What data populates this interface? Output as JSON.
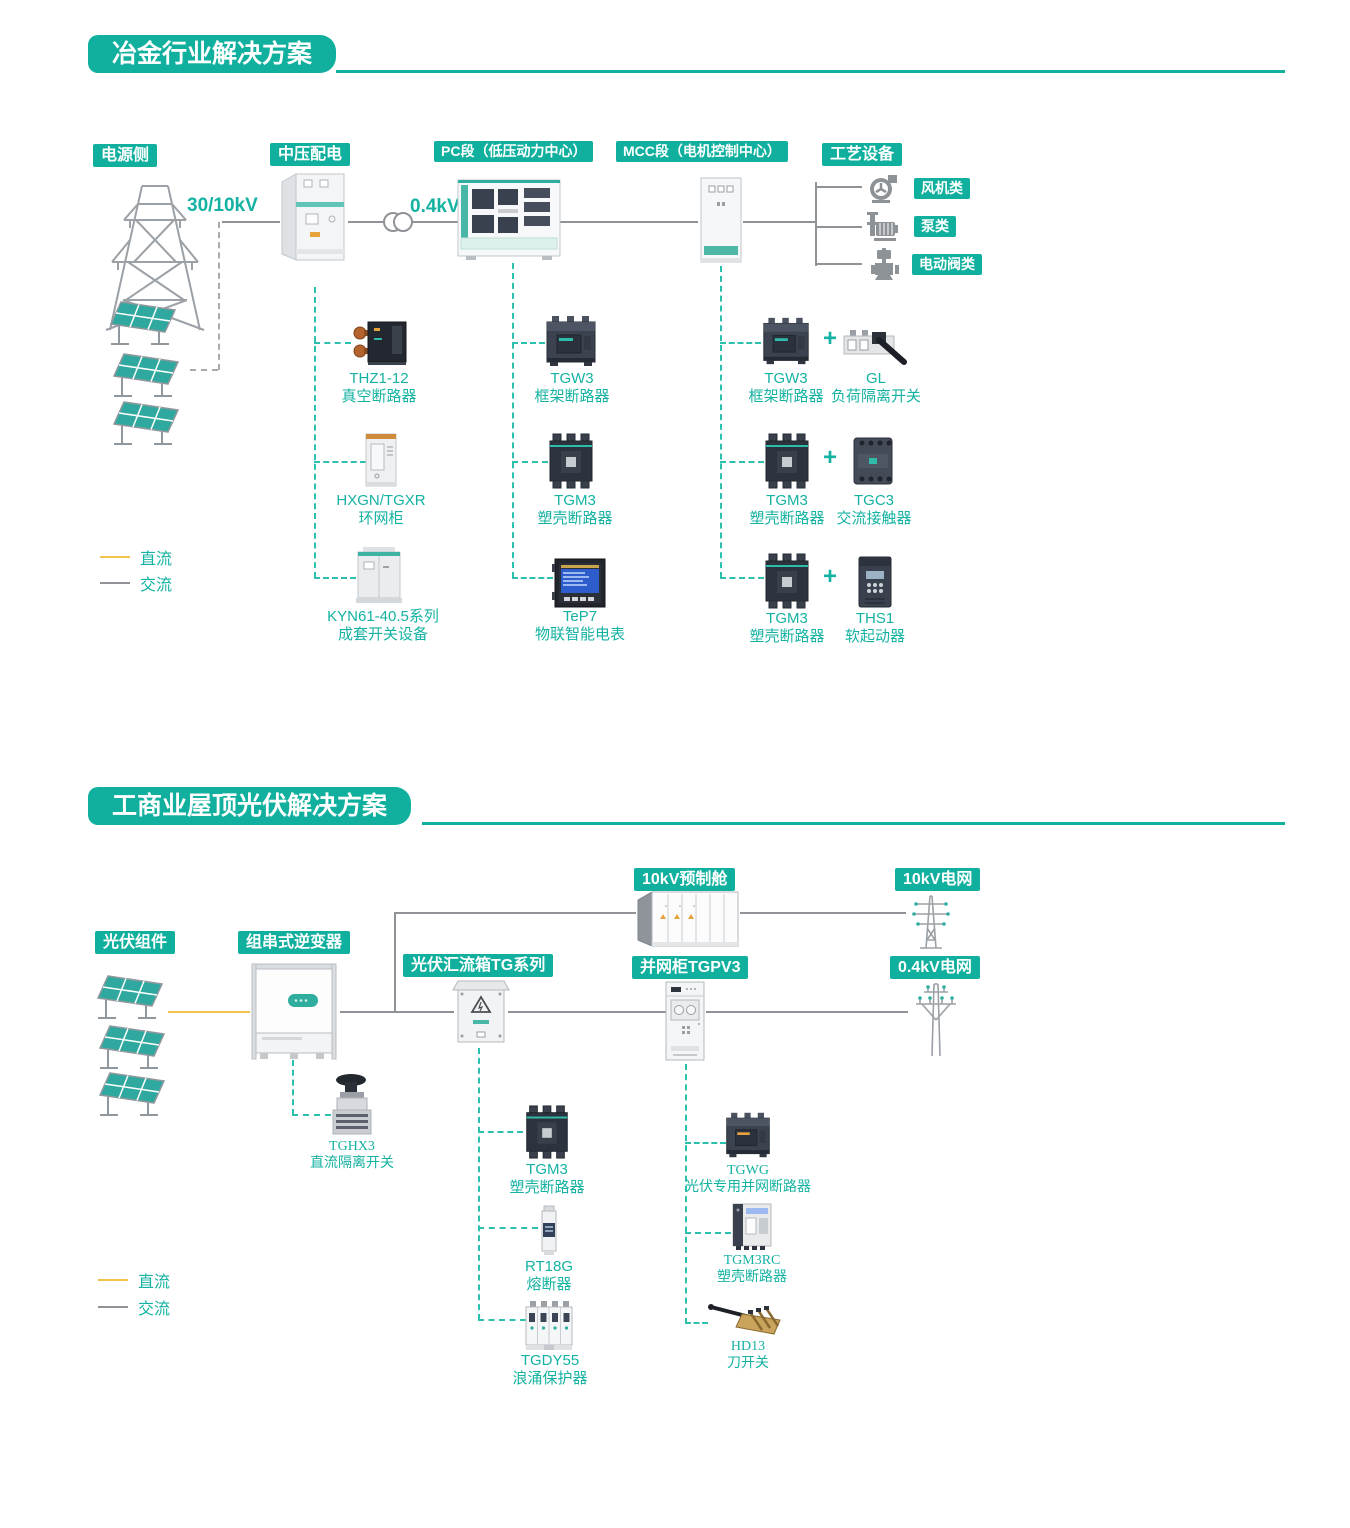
{
  "colors": {
    "teal": "#11b09e",
    "teal_dash": "#2ec0ae",
    "dc_yellow": "#f2c14e",
    "ac_gray": "#8f9296",
    "label_teal": "#14b2a2"
  },
  "s1": {
    "title": "冶金行业解决方案",
    "badges": {
      "power": "电源侧",
      "mv": "中压配电",
      "pc": "PC段（低压动力中心）",
      "mcc": "MCC段（电机控制中心）",
      "process": "工艺设备"
    },
    "voltages": {
      "grid": "30/10kV",
      "lv": "0.4kV"
    },
    "loads": [
      {
        "label": "风机类",
        "icon": "fan-icon"
      },
      {
        "label": "泵类",
        "icon": "pump-icon"
      },
      {
        "label": "电动阀类",
        "icon": "valve-icon"
      }
    ],
    "mv_products": [
      {
        "name": "THZ1-12",
        "desc": "真空断路器"
      },
      {
        "name": "HXGN/TGXR",
        "desc": "环网柜"
      },
      {
        "name": "KYN61-40.5系列",
        "desc": "成套开关设备"
      }
    ],
    "pc_products": [
      {
        "name": "TGW3",
        "desc": "框架断路器"
      },
      {
        "name": "TGM3",
        "desc": "塑壳断路器"
      },
      {
        "name": "TeP7",
        "desc": "物联智能电表"
      }
    ],
    "mcc_rows": [
      {
        "a": {
          "name": "TGW3",
          "desc": "框架断路器"
        },
        "plus": "+",
        "b": {
          "name": "GL",
          "desc": "负荷隔离开关"
        }
      },
      {
        "a": {
          "name": "TGM3",
          "desc": "塑壳断路器"
        },
        "plus": "+",
        "b": {
          "name": "TGC3",
          "desc": "交流接触器"
        }
      },
      {
        "a": {
          "name": "TGM3",
          "desc": "塑壳断路器"
        },
        "plus": "+",
        "b": {
          "name": "THS1",
          "desc": "软起动器"
        }
      }
    ],
    "legend": {
      "dc": "直流",
      "ac": "交流"
    }
  },
  "s2": {
    "title": "工商业屋顶光伏解决方案",
    "badges": {
      "pv": "光伏组件",
      "inverter": "组串式逆变器",
      "combiner": "光伏汇流箱TG系列",
      "cabin": "10kV预制舱",
      "grid10": "10kV电网",
      "tgpv3": "并网柜TGPV3",
      "grid04": "0.4kV电网"
    },
    "inverter_product": {
      "name": "TGHX3",
      "desc": "直流隔离开关"
    },
    "combiner_products": [
      {
        "name": "TGM3",
        "desc": "塑壳断路器"
      },
      {
        "name": "RT18G",
        "desc": "熔断器"
      },
      {
        "name": "TGDY55",
        "desc": "浪涌保护器"
      }
    ],
    "tgpv3_products": [
      {
        "name": "TGWG",
        "desc": "光伏专用并网断路器"
      },
      {
        "name": "TGM3RC",
        "desc": "塑壳断路器"
      },
      {
        "name": "HD13",
        "desc": "刀开关"
      }
    ],
    "legend": {
      "dc": "直流",
      "ac": "交流"
    }
  }
}
